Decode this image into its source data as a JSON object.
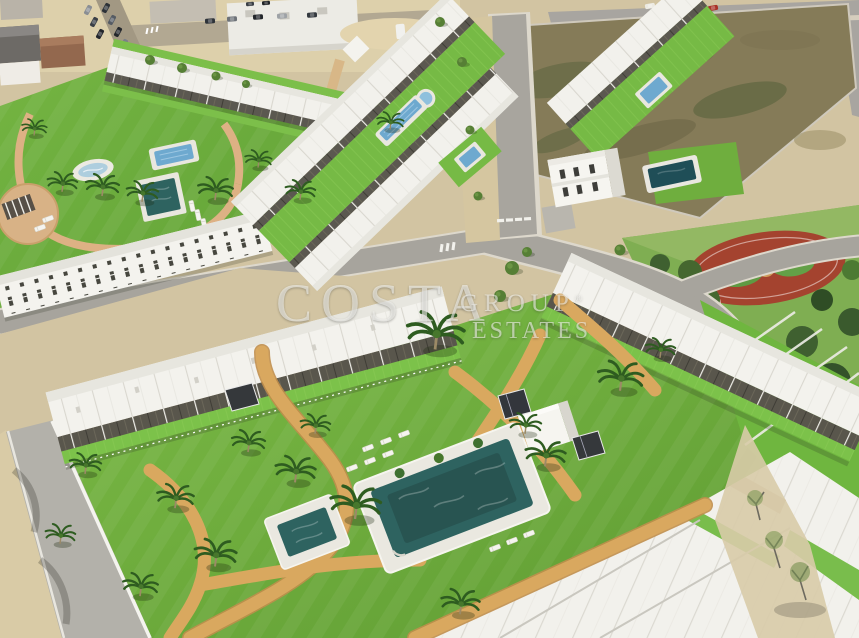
{
  "image": {
    "kind": "aerial-3d-render",
    "subject": "Aerial render of a white residential development with communal lawns, swimming pools, palm trees, a public park with red play area, roads and a vacant plot"
  },
  "watermark": {
    "line1": "COSTA",
    "line2": "GROUP",
    "registered_mark": "®",
    "line3": "ESTATES",
    "color": "#f8f8f4",
    "opacity": 0.58
  },
  "palette": {
    "lawn_green": "#6fb23e",
    "turf_green": "#7cc24a",
    "building_white": "#f3f2ed",
    "roof_shade": "#e7e6df",
    "pergola_dark": "#59564c",
    "pool_teal": "#2e6360",
    "pool_blue": "#6ea9cf",
    "pond_blue": "#aecede",
    "villa_pool_dark": "#1f4e57",
    "path_tan": "#d9a85f",
    "road_gray": "#a7a49d",
    "curb_light": "#ddd8cc",
    "sand_beige": "#d8c7a2",
    "dirt_olive": "#857b58",
    "park_grass": "#7fae52",
    "park_tree_green": "#3a5a2d",
    "track_red": "#a4432f"
  }
}
